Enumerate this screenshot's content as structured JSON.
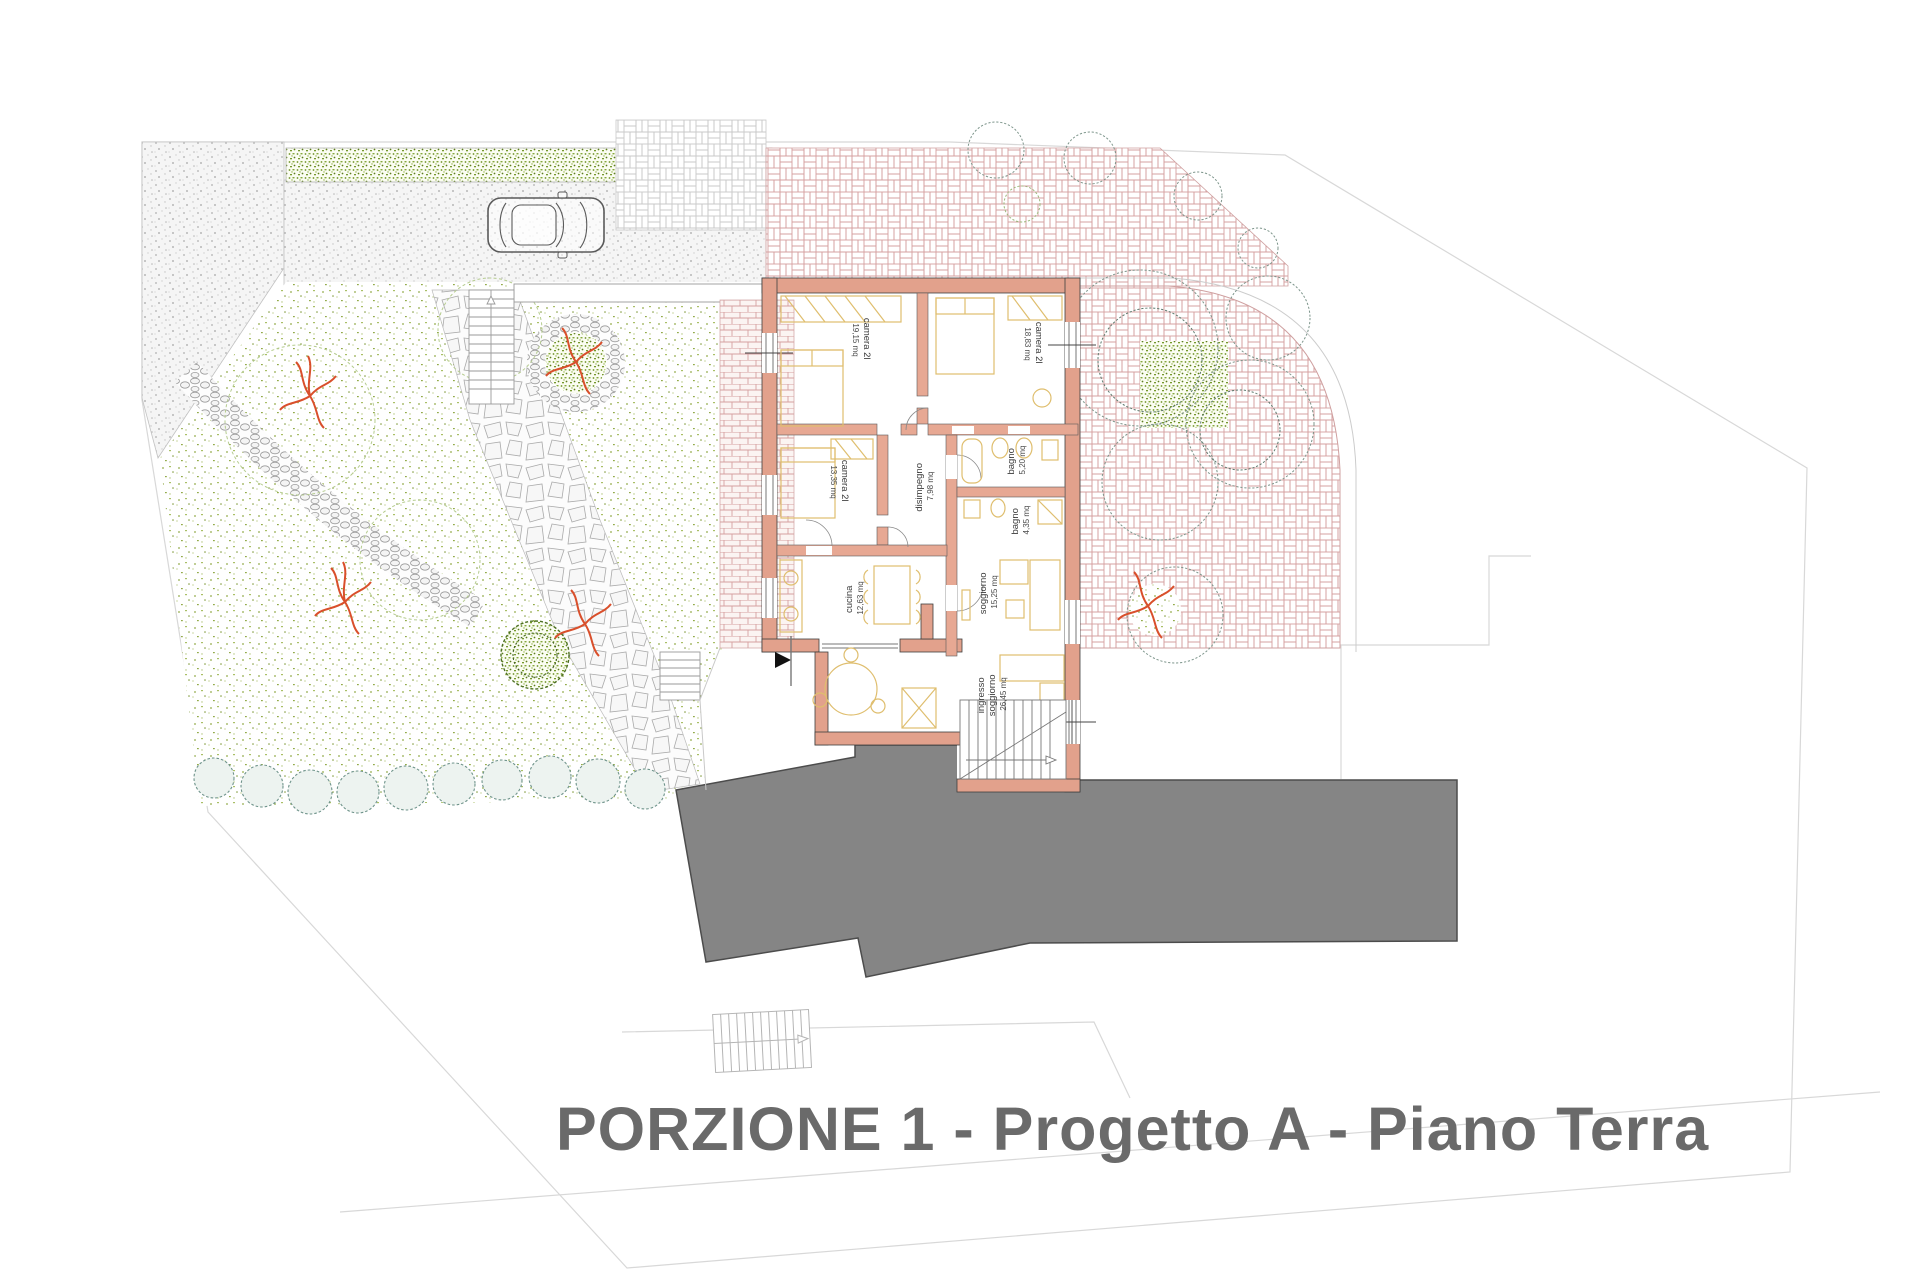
{
  "title": "PORZIONE 1 - Progetto A - Piano Terra",
  "plan": {
    "rooms": [
      {
        "label": "camera 2l",
        "area": "19,15 mq"
      },
      {
        "label": "camera 2l",
        "area": "18,83 mq"
      },
      {
        "label": "camera 2l",
        "area": "13,35 mq"
      },
      {
        "label": "disimpegno",
        "area": "7,98 mq"
      },
      {
        "label": "bagno",
        "area": "5,20 mq"
      },
      {
        "label": "bagno",
        "area": "4,35 mq"
      },
      {
        "label": "cucina",
        "area": "12,63 mq"
      },
      {
        "label": "soggiorno",
        "area": "15,25 mq"
      },
      {
        "label": "ingresso",
        "label2": "soggiorno",
        "area": "26,45 mq"
      }
    ],
    "colors": {
      "wall": "#e2a18c",
      "brick_joint": "#d6a0a0",
      "roof": "#858585",
      "title_text": "#6a6a6a",
      "garden_green": "#8aa33f",
      "hedge_green": "#6f9226",
      "furniture": "#dfbe6e",
      "plant_red": "#d94f2b",
      "shrub_teal": "#6e938a",
      "boundary": "#d8d8d8"
    }
  }
}
